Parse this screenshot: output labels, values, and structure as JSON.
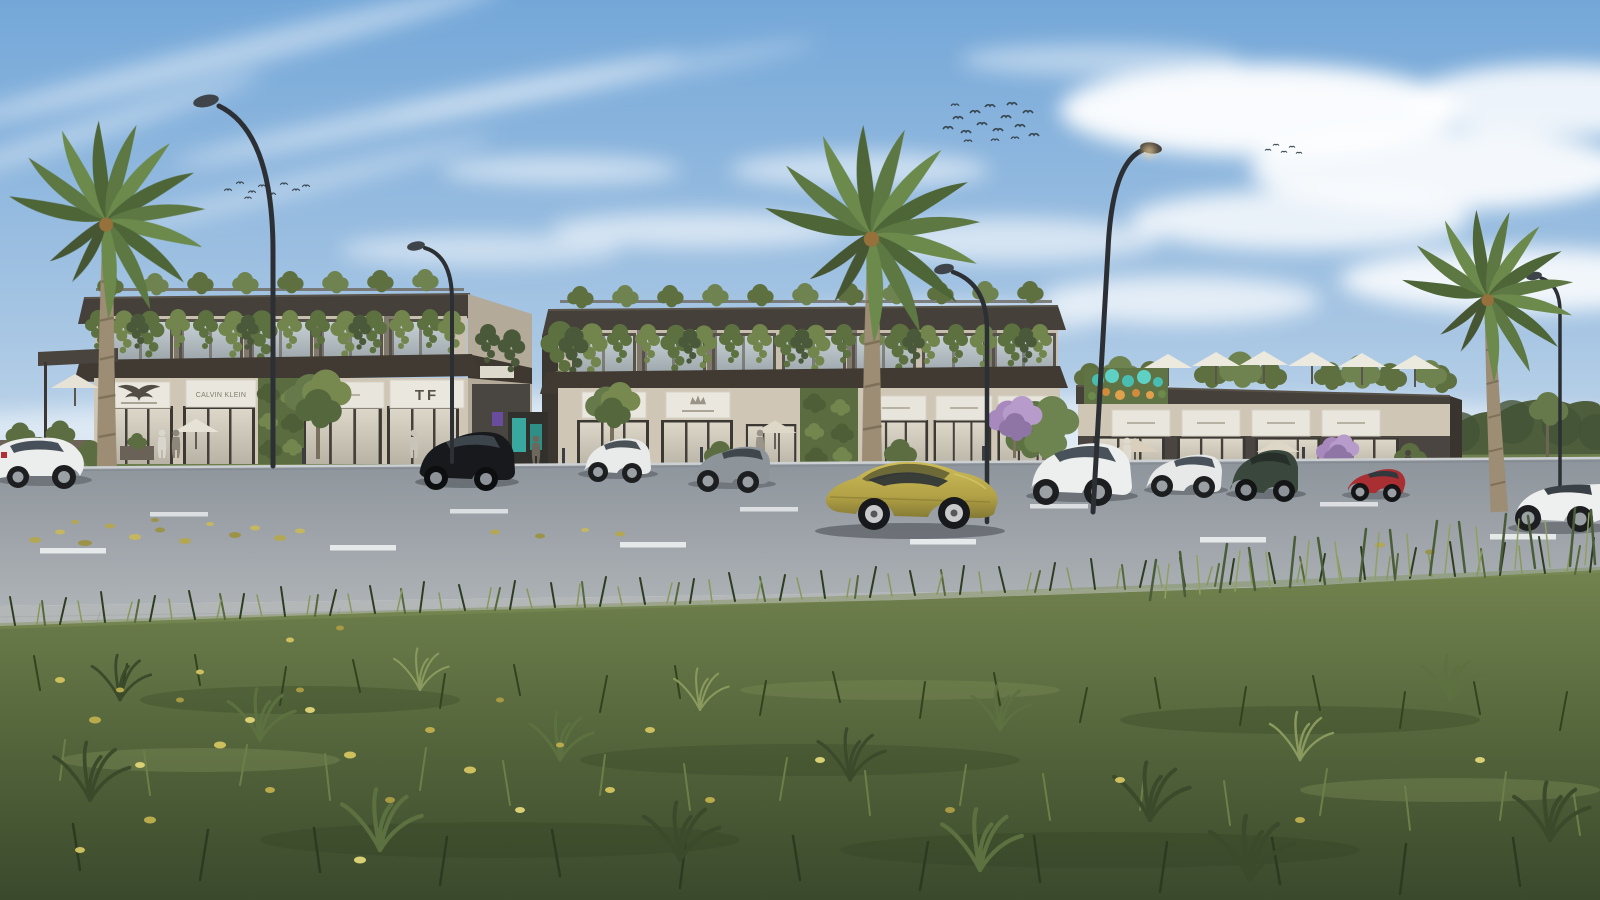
{
  "scene": {
    "description": "Daytime architectural rendering of a modern low-rise retail plaza with rooftop gardens and hanging vines, three palm trees, curved street lamps, a wide road with dashed lane markings, parked cars, a gold sports coupe driving past, and tall foreground grass scattered with fallen yellow leaves under a partly cloudy blue sky.",
    "time_of_day": "day",
    "weather": "partly cloudy",
    "bird_flocks": 3
  },
  "palette": {
    "sky_top": "#74a7d8",
    "sky_horizon": "#e3ecf3",
    "fascia_dark": "#45403a",
    "wall_beige": "#cfc6b5",
    "sign_panel": "#eae7de",
    "greenery": "#63754a",
    "road": "#979ea5",
    "road_marking": "#e4e7e9",
    "grass": "#5c6d42",
    "fallen_leaf": "#c9bb5c",
    "gold_car": "#b3a246",
    "art_wall_teal": "#49bdb2",
    "art_wall_orange": "#d28a3c"
  },
  "buildings": {
    "left": {
      "storeys": 2,
      "signs": [
        {
          "id": "emporio-armani",
          "logo": "eagle",
          "label": ""
        },
        {
          "id": "calvin-klein",
          "label": "CALVIN KLEIN"
        },
        {
          "id": "store-3",
          "label": ""
        },
        {
          "id": "tom-ford",
          "label": "TF"
        }
      ]
    },
    "middle": {
      "storeys": 2,
      "signs": [
        {
          "id": "crown-store-1",
          "logo": "crown",
          "label": ""
        },
        {
          "id": "crown-store-2",
          "logo": "crown",
          "label": ""
        },
        {
          "id": "store-3",
          "label": ""
        },
        {
          "id": "store-4",
          "label": ""
        },
        {
          "id": "store-5",
          "label": ""
        }
      ]
    },
    "right": {
      "storeys": 1,
      "rooftop_umbrellas": 6,
      "green_wall_art_sign": true,
      "signs": [
        {
          "id": "store-1",
          "label": ""
        },
        {
          "id": "store-2",
          "label": ""
        },
        {
          "id": "store-3",
          "label": ""
        },
        {
          "id": "store-4",
          "label": ""
        }
      ]
    }
  },
  "street": {
    "lamps": 5,
    "palms": 3,
    "lane_markings": "dashed white",
    "median": "grass strip with small trees, flowering bushes and bollards"
  },
  "vehicles": {
    "driving": [
      {
        "type": "sports coupe",
        "color": "gold"
      },
      {
        "type": "sedan",
        "color": "white"
      }
    ],
    "parked": [
      {
        "type": "hatchback",
        "color": "white"
      },
      {
        "type": "suv",
        "color": "black"
      },
      {
        "type": "compact suv",
        "color": "white"
      },
      {
        "type": "sedan",
        "color": "grey"
      },
      {
        "type": "suv",
        "color": "white"
      },
      {
        "type": "sedan",
        "color": "white"
      },
      {
        "type": "suv",
        "color": "dark green"
      },
      {
        "type": "coupe",
        "color": "red"
      }
    ]
  }
}
